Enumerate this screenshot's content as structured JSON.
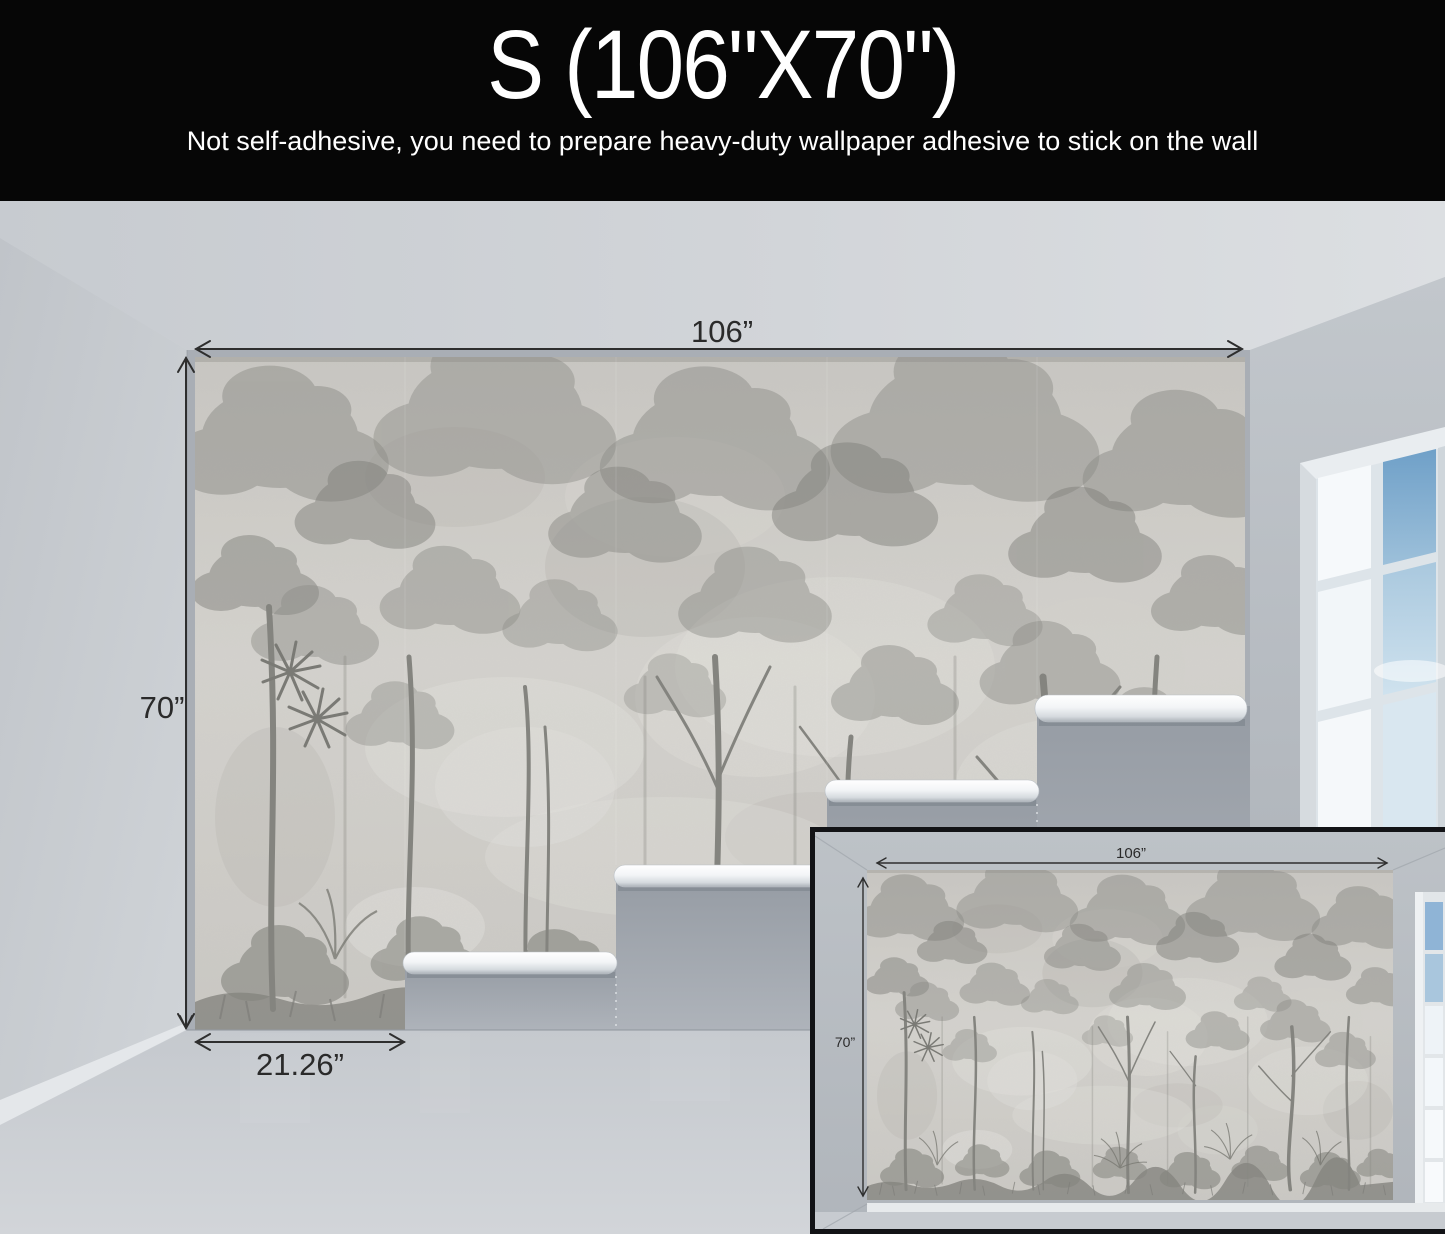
{
  "header": {
    "size_title": "S (106\"X70\")",
    "subtitle": "Not self-adhesive, you need to prepare heavy-duty wallpaper adhesive to stick on the wall"
  },
  "main_view": {
    "width_label": "106”",
    "height_label": "70”",
    "panel_width_label": "21.26”"
  },
  "inset_view": {
    "width_label": "106”",
    "height_label": "70”"
  },
  "colors": {
    "header_bg": "#060606",
    "header_text": "#ffffff",
    "dimension_text": "#2a2a2a",
    "mural_base": "#cac8c3",
    "mural_foliage": "#8d8d88",
    "bare_wall": "#9aa0a8",
    "roll_white": "#f4f6f8",
    "sky_blue": "#7fa9cd",
    "inset_border": "#121316"
  }
}
